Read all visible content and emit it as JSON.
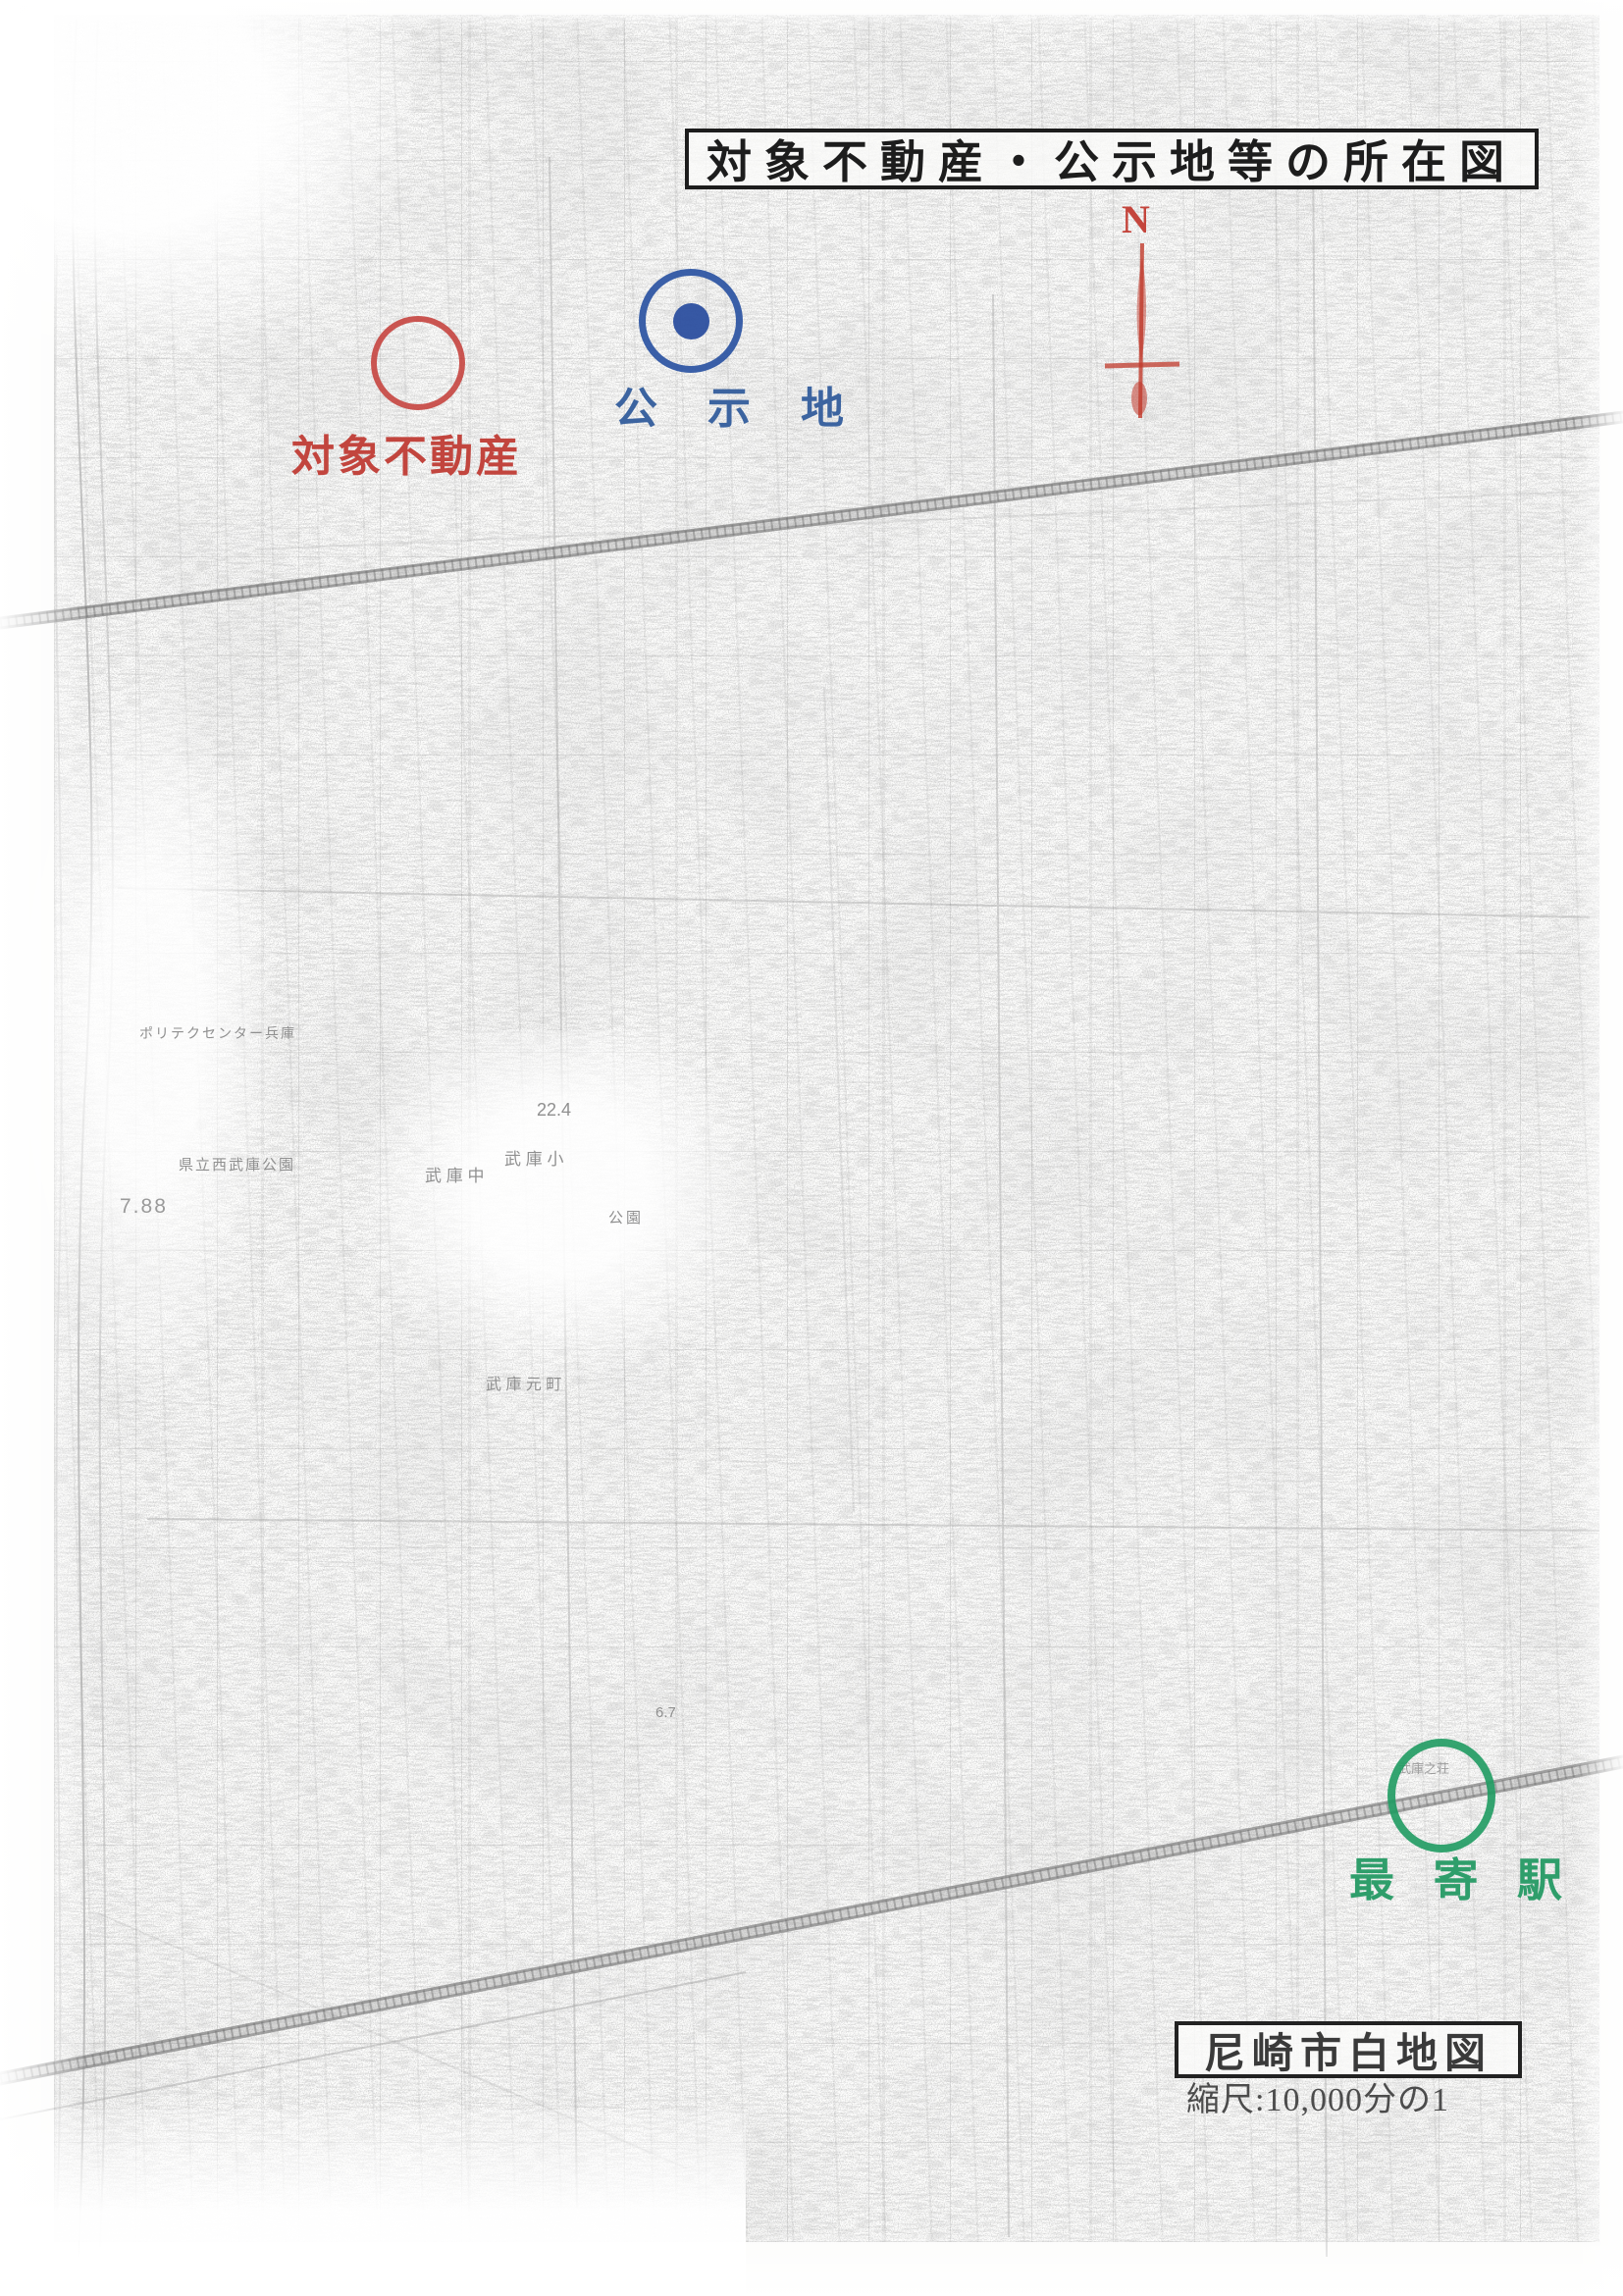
{
  "title": {
    "text": "対象不動産・公示地等の所在図"
  },
  "legend": {
    "subject_property": {
      "label": "対象不動産",
      "color": "#c2453e",
      "marker": "red-circle"
    },
    "public_notice_site": {
      "label": "公 示 地",
      "color": "#3c64a0",
      "marker": "blue-ring-with-dot"
    },
    "nearest_station": {
      "label": "最 寄 駅",
      "color": "#2f9e6b",
      "marker": "green-circle"
    }
  },
  "compass": {
    "label": "N",
    "color": "#c4453c"
  },
  "footer": {
    "map_name": "尼崎市白地図",
    "scale": "縮尺:10,000分の1"
  },
  "map_labels": [
    {
      "text": "22.4"
    },
    {
      "text": "武 庫 中"
    },
    {
      "text": "武 庫 小"
    },
    {
      "text": "公園"
    },
    {
      "text": "県立西武庫公園"
    },
    {
      "text": "7.88"
    },
    {
      "text": "武 庫 元 町"
    },
    {
      "text": "武庫之荘"
    },
    {
      "text": "ポリテクセンター兵庫"
    },
    {
      "text": "6.7"
    }
  ]
}
